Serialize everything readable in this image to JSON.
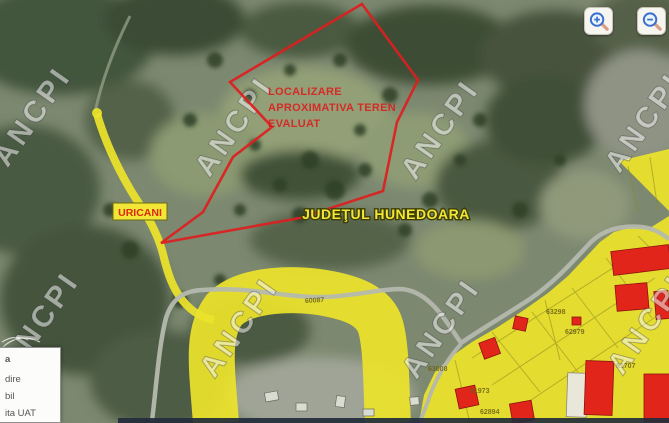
{
  "map": {
    "watermark_text": "ANCPI",
    "annotation_lines": [
      "LOCALIZARE",
      "APROXIMATIVA TEREN",
      "EVALUAT"
    ],
    "town_label": "URICANI",
    "county_label": "JUDEŢUL HUNEDOARA",
    "parcel_labels": [
      {
        "text": "60087"
      },
      {
        "text": "63298"
      },
      {
        "text": "62979"
      },
      {
        "text": "63008"
      },
      {
        "text": "61973"
      },
      {
        "text": "62894"
      },
      {
        "text": "61707"
      }
    ],
    "colors": {
      "highlight_yellow": "#ece32b",
      "boundary_red": "#dc1f1f",
      "building_red": "#e1251b",
      "road_gray": "#b5b9ae"
    }
  },
  "legend": {
    "items": [
      {
        "text": "a"
      },
      {
        "text": "dire"
      },
      {
        "text": "bil"
      },
      {
        "text": "ita UAT"
      }
    ]
  },
  "controls": {
    "buttons": [
      {
        "icon": "zoom-in"
      },
      {
        "icon": "zoom-out"
      }
    ]
  }
}
